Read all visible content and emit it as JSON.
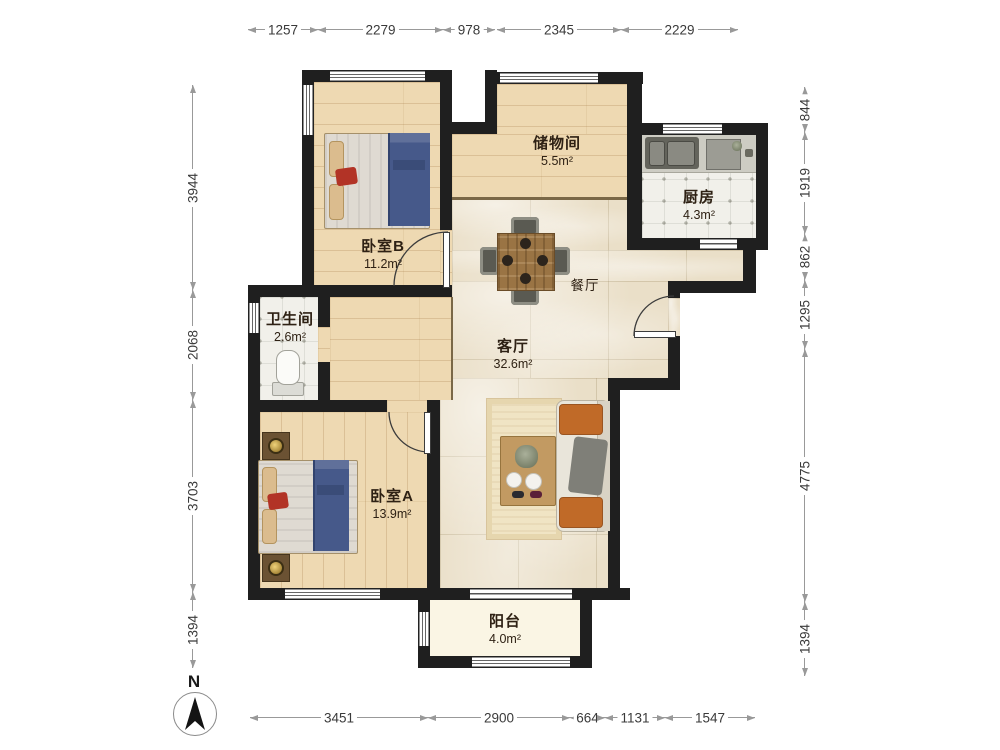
{
  "compass": {
    "north_label": "N"
  },
  "rooms": {
    "bedroomB": {
      "name": "卧室B",
      "area": "11.2m²"
    },
    "storage": {
      "name": "储物间",
      "area": "5.5m²"
    },
    "kitchen": {
      "name": "厨房",
      "area": "4.3m²"
    },
    "bathroom": {
      "name": "卫生间",
      "area": "2.6m²"
    },
    "living": {
      "name": "客厅",
      "area": "32.6m²"
    },
    "dining": {
      "name": "餐厅"
    },
    "bedroomA": {
      "name": "卧室A",
      "area": "13.9m²"
    },
    "balcony": {
      "name": "阳台",
      "area": "4.0m²"
    }
  },
  "dimensions": {
    "top": [
      "1257",
      "2279",
      "978",
      "2345",
      "2229"
    ],
    "bottom": [
      "3451",
      "2900",
      "664",
      "1131",
      "1547"
    ],
    "left": [
      "3944",
      "2068",
      "3703",
      "1394"
    ],
    "right": [
      "844",
      "1919",
      "862",
      "1295",
      "4775",
      "1394"
    ]
  },
  "colors": {
    "wall": "#1f1f1f",
    "wood_floor": "#eed9b2",
    "marble_floor": "#eadfc8",
    "tile_floor": "#f1f0ea",
    "duvet_blue": "#46598a",
    "accent_pillow_red": "#b23326",
    "sofa_pillow_orange": "#c06a28"
  }
}
